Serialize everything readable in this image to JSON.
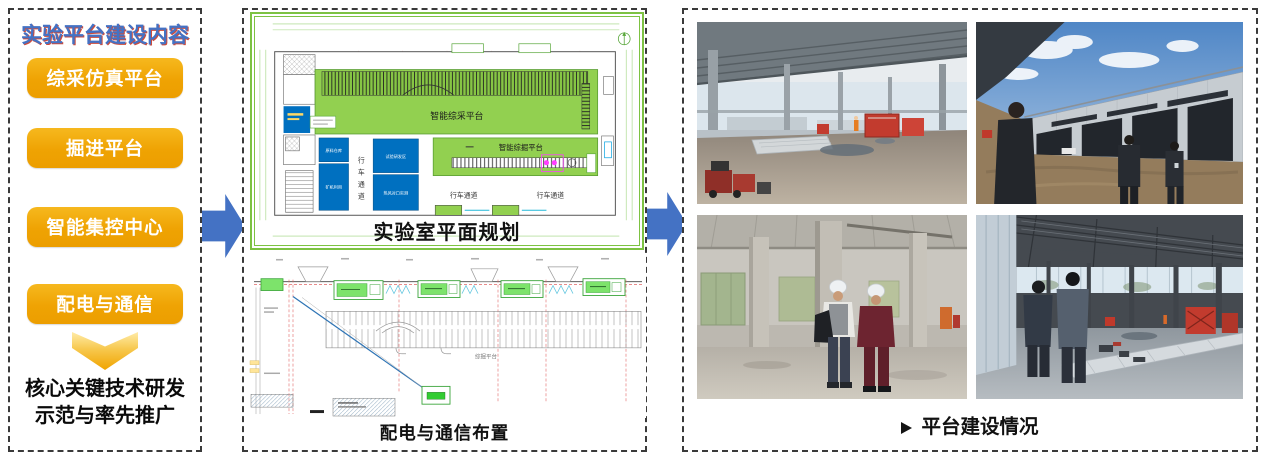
{
  "colors": {
    "accent_blue": "#4472C4",
    "button_amber": "#F0A400",
    "frame_green": "#7DC242",
    "plan_green": "#92D050",
    "plan_blue": "#0070C0"
  },
  "left_panel": {
    "title": "实验平台建设内容",
    "buttons": [
      {
        "label": "综采仿真平台"
      },
      {
        "label": "掘进平台"
      },
      {
        "label": "智能集控中心"
      },
      {
        "label": "配电与通信"
      }
    ],
    "conclusion": {
      "line1": "核心关键技术研发",
      "line2": "示范与率先推广"
    }
  },
  "middle_panel": {
    "plan": {
      "caption": "实验室平面规划",
      "area_mining": "智能综采平台",
      "area_tunneling": "智能综掘平台",
      "corridor_chars": [
        "行",
        "车",
        "通",
        "道"
      ],
      "corridor_left": "行车通道",
      "corridor_right": "行车通道",
      "room_blue_1": "原料仓库",
      "room_blue_2": "矿机利用",
      "room_blue_3": "试验研发区",
      "room_blue_4": "热风对口实测"
    },
    "wiring": {
      "caption": "配电与通信布置",
      "area_label": "综掘平台"
    }
  },
  "right_panel": {
    "bullet_icon": "arrowhead-right",
    "caption_text": "平台建设情况"
  }
}
